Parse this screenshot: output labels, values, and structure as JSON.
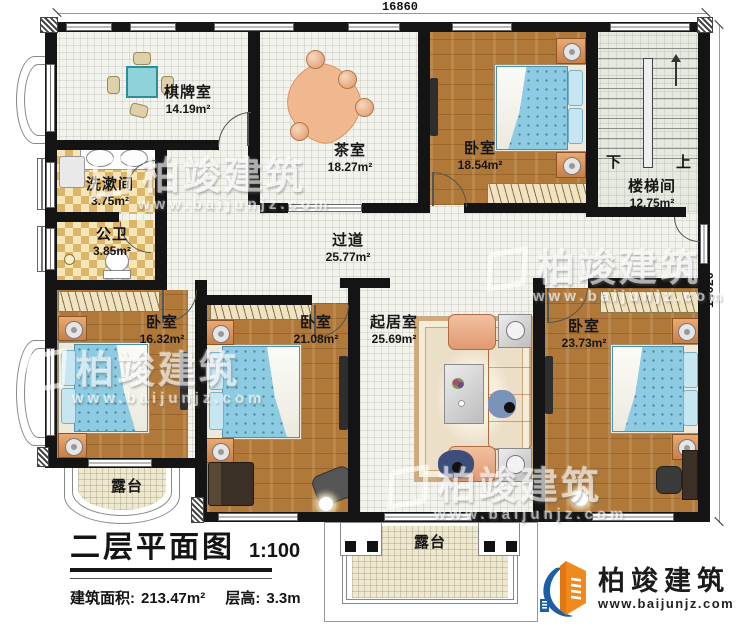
{
  "plan": {
    "dimensions": {
      "top": "16860",
      "right": "14620"
    },
    "rooms": {
      "chess": {
        "name": "棋牌室",
        "area": "14.19m²"
      },
      "tea": {
        "name": "茶室",
        "area": "18.27m²"
      },
      "bedroom_ne": {
        "name": "卧室",
        "area": "18.54m²"
      },
      "stairwell": {
        "name": "楼梯间",
        "area": "12.75m²"
      },
      "washroom": {
        "name": "洗漱间",
        "area": "3.75m²"
      },
      "toilet": {
        "name": "公卫",
        "area": "3.85m²"
      },
      "corridor": {
        "name": "过道",
        "area": "25.77m²"
      },
      "bedroom_sw": {
        "name": "卧室",
        "area": "16.32m²"
      },
      "bedroom_s": {
        "name": "卧室",
        "area": "21.08m²"
      },
      "living": {
        "name": "起居室",
        "area": "25.69m²"
      },
      "bedroom_se": {
        "name": "卧室",
        "area": "23.73m²"
      },
      "terrace_sw": {
        "name": "露台"
      },
      "terrace_s": {
        "name": "露台"
      }
    },
    "stairs": {
      "down": "下",
      "up": "上"
    }
  },
  "title_block": {
    "title": "二层平面图",
    "scale": "1:100",
    "area_label": "建筑面积:",
    "area_value": "213.47m²",
    "height_label": "层高:",
    "height_value": "3.3m"
  },
  "branding": {
    "company": "柏竣建筑",
    "website": "www.baijunjz.com"
  },
  "watermark": {
    "company": "柏竣建筑",
    "website": "www.baijunjz.com"
  },
  "colors": {
    "wall": "#141414",
    "wood_floor": "#b0793a",
    "bed": "#8ccbe2",
    "sofa": "#e8a87e",
    "tile_light": "#f4e6ba",
    "tile_dark": "#ddb567",
    "logo_blue": "#1c5fa8",
    "logo_orange": "#f08a1e"
  }
}
